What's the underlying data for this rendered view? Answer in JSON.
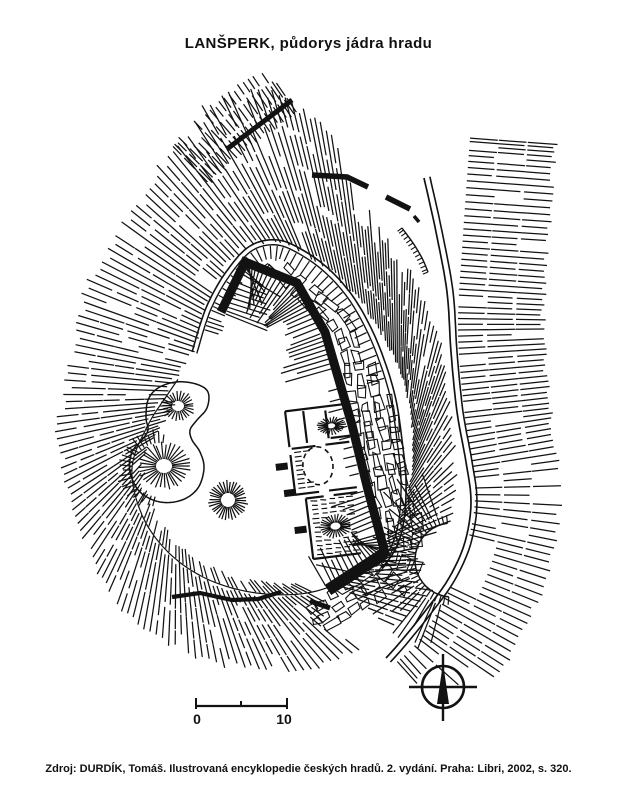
{
  "title": "LANŠPERK, půdorys jádra hradu",
  "source": "Zdroj: DURDÍK, Tomáš. Ilustrovaná encyklopedie českých hradů. 2. vydání. Praha: Libri, 2002, s. 320.",
  "scalebar": {
    "start": "0",
    "end": "10"
  },
  "colors": {
    "ink": "#121212",
    "paper": "#ffffff"
  }
}
